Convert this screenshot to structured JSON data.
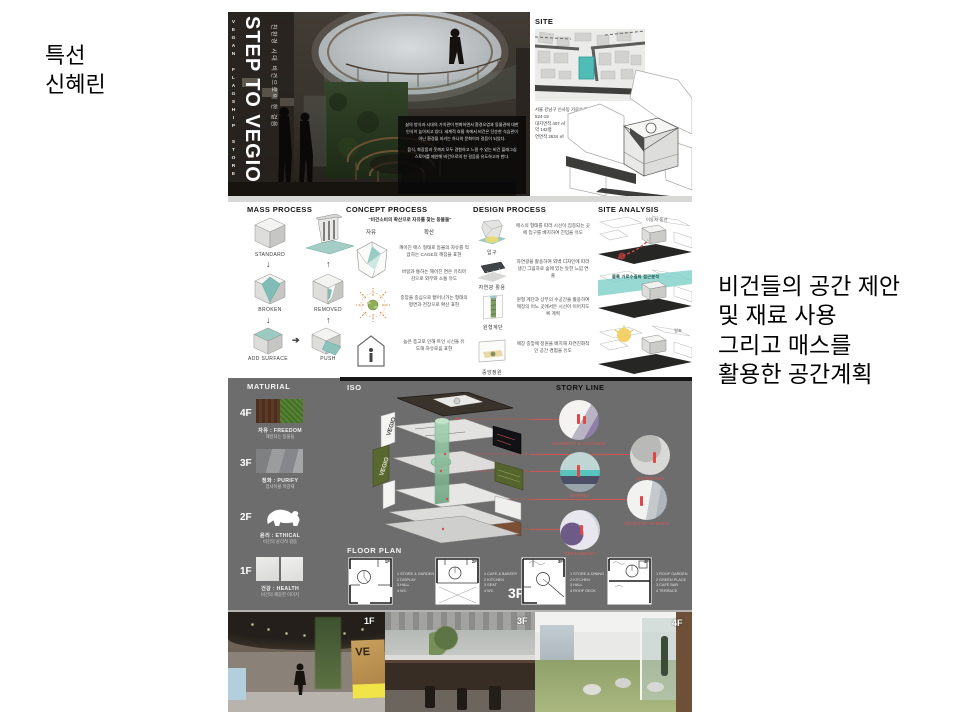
{
  "left_caption": {
    "line1": "특선",
    "line2": "신혜린"
  },
  "right_caption": {
    "lines": [
      "비건들의 공간 제안",
      "및 재료 사용",
      "그리고 매스를",
      "활용한 공간계획"
    ]
  },
  "board": {
    "hero": {
      "side_vertical": "VEGAN FLAGSHIP STORE",
      "title": "STEP TO VEGIO",
      "subtitle": "친환경 시대 비건으로의 한 걸음",
      "intro_p1": "삶의 방식과 시대의 가치관이 변화하면서 환경오염과 동물권에 대한 인식이 높아지고 있다. 세계적 흐름 속에서 비건은 단순한 식습관이 아닌 환경을 지키는 하나의 문화이자 걸음이 되었다.",
      "intro_p2": "음식, 화장품과 옷까지 모두 경험하고 느낄 수 있는 비건 플래그십 스토어를 제안해 비건으로의 한 걸음을 유도하고자 한다."
    },
    "site": {
      "heading": "SITE",
      "address": "서울 강남구 신사동 가로수길\n524-19\n대지면적 407 ㎡\n약 142평\n연면적 2634 ㎡"
    },
    "mass_process": {
      "heading": "MASS PROCESS",
      "labels": {
        "standard": "STANDARD",
        "broken": "BROKEN",
        "removed": "REMOVED",
        "add_surface": "ADD SURFACE",
        "push": "PUSH"
      }
    },
    "concept_process": {
      "heading": "CONCEPT PROCESS",
      "quote": "\"비건소비의 확산으로 자유를 찾는 동물들\"",
      "left_key": "자유",
      "right_key": "확산",
      "item1a": "깨어진 매스 형태로 동물의 자유를 억압하는 CAGE의 깨짐을 표현",
      "item1b": "바람과 통하는 깨어진 면은 유리마감으로 외부와 소통 유도",
      "item2": "중앙을 중심으로 뻗어나가는 형태의 평면과 천장으로 확산 표현",
      "item3": "높은 층고로 인해 트인 시선을 유도해 자유로움 표현"
    },
    "design_process": {
      "heading": "DESIGN PROCESS",
      "items": [
        {
          "label": "입구",
          "text": "매스의 형태를 따라 시선이 집중되는 곳에 입구를 배치하여 진입을 유도"
        },
        {
          "label": "자연광 활용",
          "text": "자연광을 활용하여 외벽 디자인에 따라 생긴 그림자로 숲에 있는 듯한 느낌 연출"
        },
        {
          "label": "원형계단",
          "text": "원형 계단과 상부의 수공간을 활용하여 매장의 어느 곳에서든 시선이 이어지도록 계획"
        },
        {
          "label": "중앙정원",
          "text": "매장 중앙에 정원을 배치해 자연친화적인 공간 경험을 유도"
        }
      ]
    },
    "site_analysis": {
      "heading": "SITE ANALYSIS",
      "captions": [
        "이동자 동선",
        "블록 가로수길의 접근분석",
        "일조"
      ]
    },
    "material": {
      "heading": "MATURIAL",
      "floors": [
        {
          "floor": "4F",
          "title": "자유 : FREEDOM",
          "sub": "해방되는 동물들"
        },
        {
          "floor": "3F",
          "title": "정화 : PURIFY",
          "sub": "업사이클 마감재"
        },
        {
          "floor": "2F",
          "title": "윤리 : ETHICAL",
          "sub": "비건의 윤리적 걸음"
        },
        {
          "floor": "1F",
          "title": "건강 : HEALTH",
          "sub": "비건의 깨끗한 이미지"
        }
      ]
    },
    "iso": {
      "heading": "ISO",
      "panel_label_1": "VEGIO",
      "panel_label_2": "VEGIO"
    },
    "story_line": {
      "heading": "STORY LINE",
      "captions": [
        "COSMETIC & CLOTHING",
        "MARKET",
        "RESTAURANT",
        "SHOWROOM",
        "ROOFTOP GARDEN"
      ]
    },
    "floor_plan": {
      "heading": "FLOOR PLAN",
      "big_label": "3F",
      "plans": [
        {
          "label": "1F",
          "legend": "1 STORE & GARDEN\n2 DISPLAY\n3 HALL\n4 WC"
        },
        {
          "label": "2F",
          "legend": "1 CAFE & BAKERY\n2 KITCHEN\n3 SEAT\n4 WC"
        },
        {
          "label": "3F",
          "legend": "1 STORE & DINING\n2 KITCHEN\n3 HALL\n4 ROOF DECK"
        },
        {
          "label": "4F",
          "legend": "1 ROOF GARDEN\n2 GREEN PLACE\n3 CAFE BAR\n4 TERRACE"
        }
      ]
    },
    "renders": [
      {
        "label": "1F",
        "sign": "VE"
      },
      {
        "label": "3F"
      },
      {
        "label": "4F"
      }
    ],
    "colors": {
      "accent_teal": "#6fc2ba",
      "band_gray": "#6d6d6d",
      "annotation_red": "#d94a48",
      "olive": "#5c6b33"
    }
  }
}
